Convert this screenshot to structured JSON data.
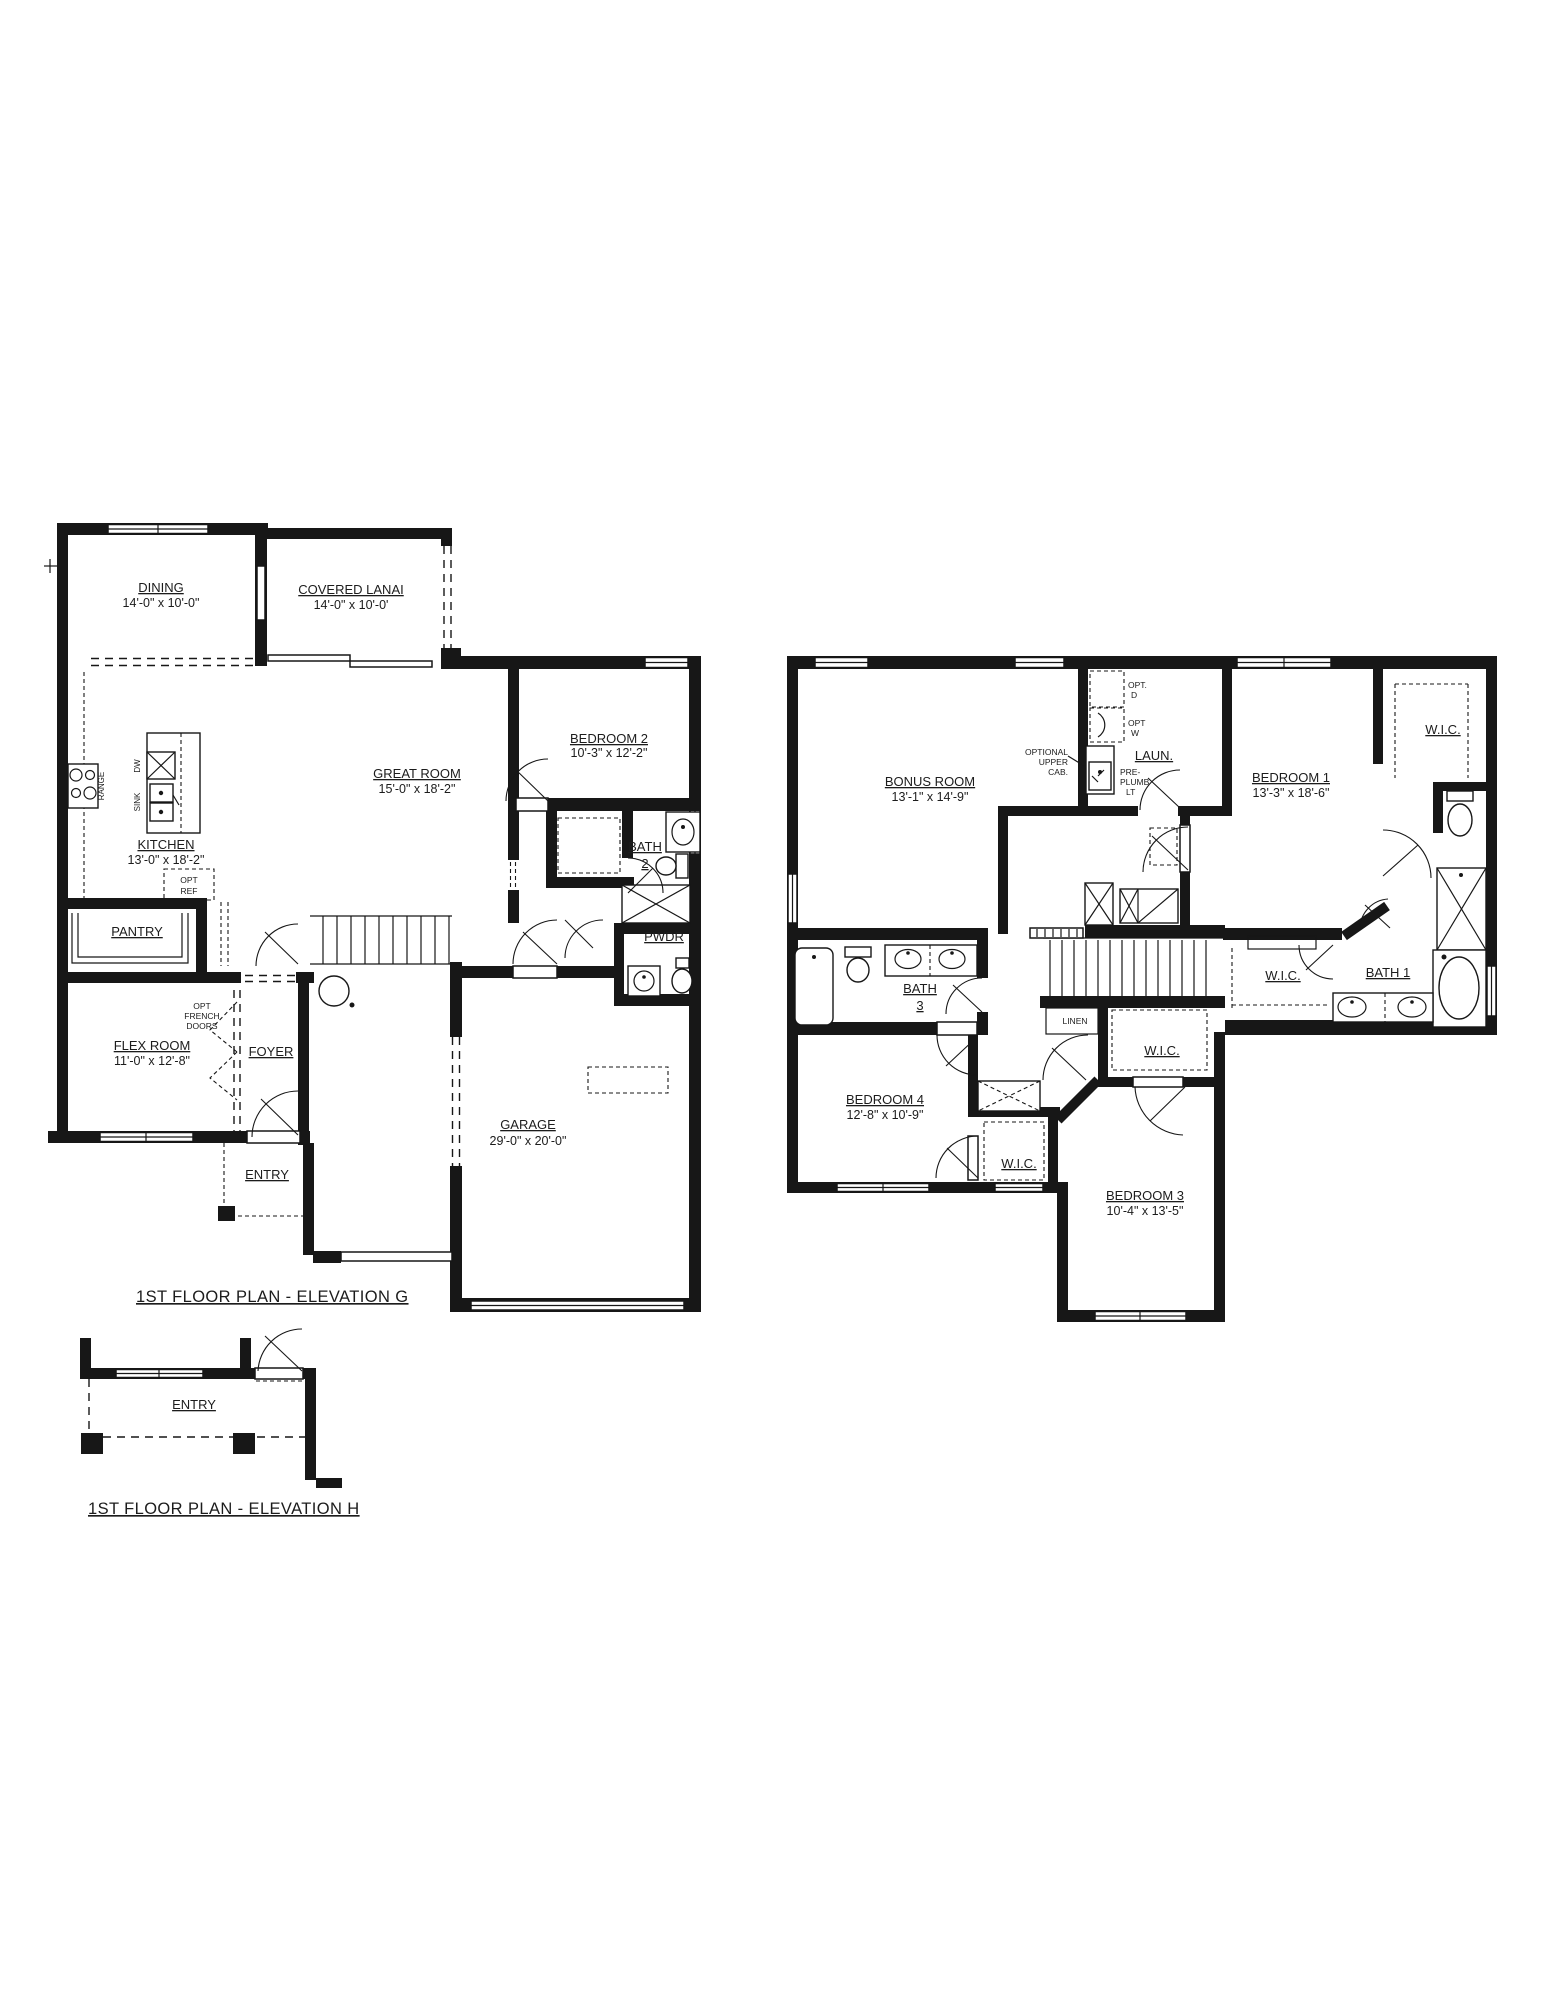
{
  "sheet": {
    "background": "#ffffff",
    "ink": "#171717"
  },
  "g": {
    "caption": "1ST FLOOR PLAN - ELEVATION G",
    "dining": {
      "name": "DINING",
      "dims": "14'-0\" x 10'-0\""
    },
    "lanai": {
      "name": "COVERED LANAI",
      "dims": "14'-0\" x 10'-0'"
    },
    "great": {
      "name": "GREAT ROOM",
      "dims": "15'-0\" x 18'-2\""
    },
    "kitchen": {
      "name": "KITCHEN",
      "dims": "13'-0\" x 18'-2\""
    },
    "bedroom2": {
      "name": "BEDROOM 2",
      "dims": "10'-3\" x 12'-2\""
    },
    "bath2": {
      "name": "BATH",
      "num": "2"
    },
    "pwdr": {
      "name": "PWDR"
    },
    "pantry": {
      "name": "PANTRY"
    },
    "flex": {
      "name": "FLEX ROOM",
      "dims": "11'-0\" x 12'-8\""
    },
    "foyer": {
      "name": "FOYER"
    },
    "entry": {
      "name": "ENTRY"
    },
    "garage": {
      "name": "GARAGE",
      "dims": "29'-0\" x 20'-0\""
    },
    "notes": {
      "opt_french": [
        "OPT",
        "FRENCH",
        "DOORS"
      ],
      "opt_ref": [
        "OPT",
        "REF"
      ],
      "range": "RANGE",
      "dw": "DW",
      "sink": "SINK"
    }
  },
  "upper": {
    "bonus": {
      "name": "BONUS ROOM",
      "dims": "13'-1\" x 14'-9\""
    },
    "laundry": {
      "name": "LAUN."
    },
    "bedroom1": {
      "name": "BEDROOM 1",
      "dims": "13'-3\" x 18'-6\""
    },
    "bedroom3": {
      "name": "BEDROOM 3",
      "dims": "10'-4\" x 13'-5\""
    },
    "bedroom4": {
      "name": "BEDROOM 4",
      "dims": "12'-8\" x 10'-9\""
    },
    "bath1": {
      "name": "BATH 1"
    },
    "bath3": {
      "name": "BATH",
      "num": "3"
    },
    "wic": "W.I.C.",
    "linen": "LINEN",
    "notes": {
      "opt_d": [
        "OPT.",
        "D"
      ],
      "opt_w": [
        "OPT",
        "W"
      ],
      "upper_cab": [
        "OPTIONAL",
        "UPPER",
        "CAB."
      ],
      "pre_plumb": [
        "PRE-",
        "PLUMB",
        "LT"
      ]
    }
  },
  "h": {
    "caption": "1ST FLOOR PLAN - ELEVATION H",
    "entry": "ENTRY"
  }
}
